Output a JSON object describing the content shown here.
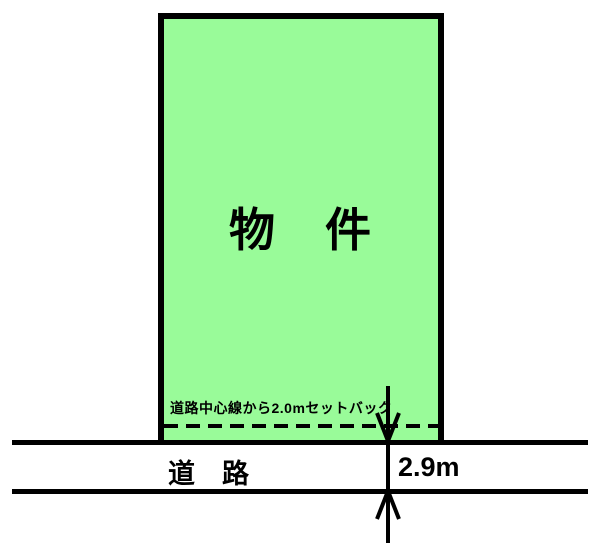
{
  "diagram": {
    "title": "setback-site-plan",
    "property": {
      "label": "物　件",
      "fill_color": "#99fb99",
      "border_color": "#000000"
    },
    "setback": {
      "note": "道路中心線から2.0mセットバック",
      "line_style": "dashed"
    },
    "road": {
      "label": "道　路",
      "width_label": "2.9m"
    },
    "icons": {
      "arrow_down": "open-v-arrowhead-down",
      "arrow_up": "open-v-arrowhead-up"
    },
    "colors": {
      "line": "#000000",
      "background": "#ffffff"
    }
  }
}
